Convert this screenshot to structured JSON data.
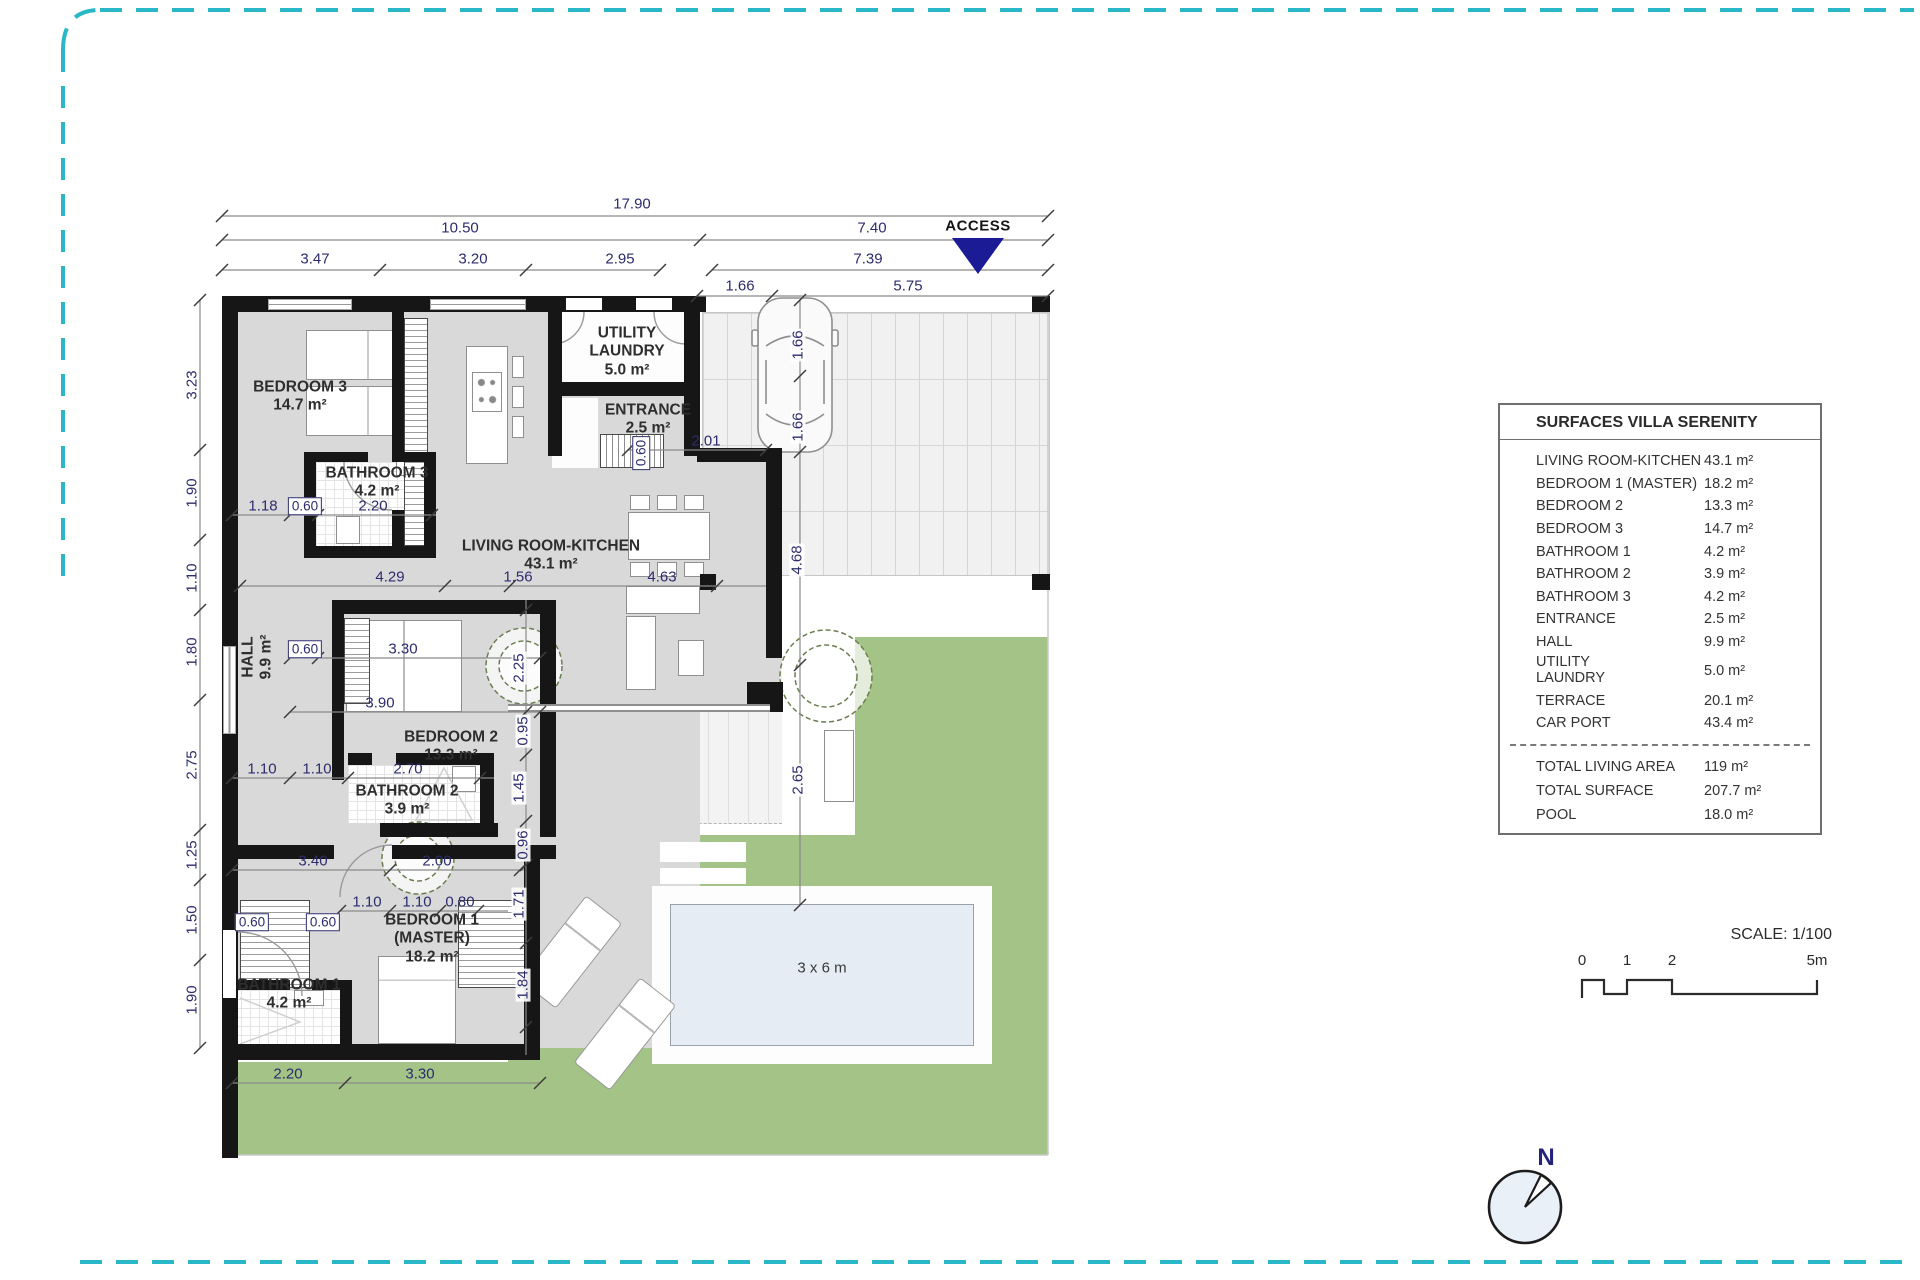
{
  "plan": {
    "access_label": "ACCESS",
    "pool_label": "3 x 6 m",
    "dims": [
      "17.90",
      "10.50",
      "7.40",
      "3.47",
      "3.20",
      "2.95",
      "7.39",
      "1.66",
      "5.75",
      "3.23",
      "1.90",
      "1.10",
      "1.80",
      "2.75",
      "1.25",
      "1.50",
      "1.90",
      "1.66",
      "1.66",
      "4.68",
      "2.65",
      "2.01",
      "0.60",
      "1.18",
      "0.60",
      "2.20",
      "4.29",
      "1.56",
      "4.63",
      "0.60",
      "3.30",
      "3.90",
      "1.10",
      "1.10",
      "2.70",
      "3.40",
      "2.00",
      "1.10",
      "1.10",
      "0.80",
      "0.60",
      "0.60",
      "2.25",
      "0.95",
      "1.45",
      "0.96",
      "1.71",
      "1.84",
      "2.20",
      "3.30"
    ],
    "rooms": {
      "bedroom3": {
        "l1": "BEDROOM 3",
        "l2": "14.7 m²"
      },
      "bathroom3": {
        "l1": "BATHROOM 3",
        "l2": "4.2 m²"
      },
      "utility": {
        "l1": "UTILITY",
        "l2": "LAUNDRY",
        "l3": "5.0 m²"
      },
      "entrance": {
        "l1": "ENTRANCE",
        "l2": "2.5 m²"
      },
      "living": {
        "l1": "LIVING ROOM-KITCHEN",
        "l2": "43.1 m²"
      },
      "hall": {
        "l1": "HALL",
        "l2": "9.9 m²"
      },
      "bedroom2": {
        "l1": "BEDROOM 2",
        "l2": "13.3 m²"
      },
      "bathroom2": {
        "l1": "BATHROOM 2",
        "l2": "3.9 m²"
      },
      "bedroom1": {
        "l1": "BEDROOM 1",
        "l2": "(MASTER)",
        "l3": "18.2 m²"
      },
      "bathroom1": {
        "l1": "BATHROOM 1",
        "l2": "4.2 m²"
      }
    }
  },
  "table": {
    "title": "SURFACES VILLA SERENITY",
    "rows": [
      {
        "label": "LIVING ROOM-KITCHEN",
        "value": "43.1 m²"
      },
      {
        "label": "BEDROOM 1 (MASTER)",
        "value": "18.2 m²"
      },
      {
        "label": "BEDROOM 2",
        "value": "13.3 m²"
      },
      {
        "label": "BEDROOM 3",
        "value": "14.7 m²"
      },
      {
        "label": "BATHROOM 1",
        "value": "4.2 m²"
      },
      {
        "label": "BATHROOM 2",
        "value": "3.9 m²"
      },
      {
        "label": "BATHROOM 3",
        "value": "4.2 m²"
      },
      {
        "label": "ENTRANCE",
        "value": "2.5 m²"
      },
      {
        "label": "HALL",
        "value": "9.9 m²"
      },
      {
        "label": "UTILITY\nLAUNDRY",
        "value": "5.0 m²"
      },
      {
        "label": "TERRACE",
        "value": "20.1 m²"
      },
      {
        "label": "CAR PORT",
        "value": "43.4 m²"
      }
    ],
    "totals": [
      {
        "label": "TOTAL LIVING AREA",
        "value": "119 m²"
      },
      {
        "label": "TOTAL SURFACE",
        "value": "207.7 m²"
      },
      {
        "label": "POOL",
        "value": "18.0 m²"
      }
    ]
  },
  "scale": {
    "label": "SCALE: 1/100",
    "ticks": [
      "0",
      "1",
      "2",
      "5m"
    ]
  },
  "compass": {
    "label": "N"
  },
  "colors": {
    "border_teal": "#2ab8c8",
    "wall_black": "#161616",
    "floor_gray": "#d9d9d9",
    "garden_green": "#a4c386",
    "pool_water": "#e6ecf3",
    "dim_navy": "#2c2c6e",
    "access_navy": "#1b1b96"
  }
}
